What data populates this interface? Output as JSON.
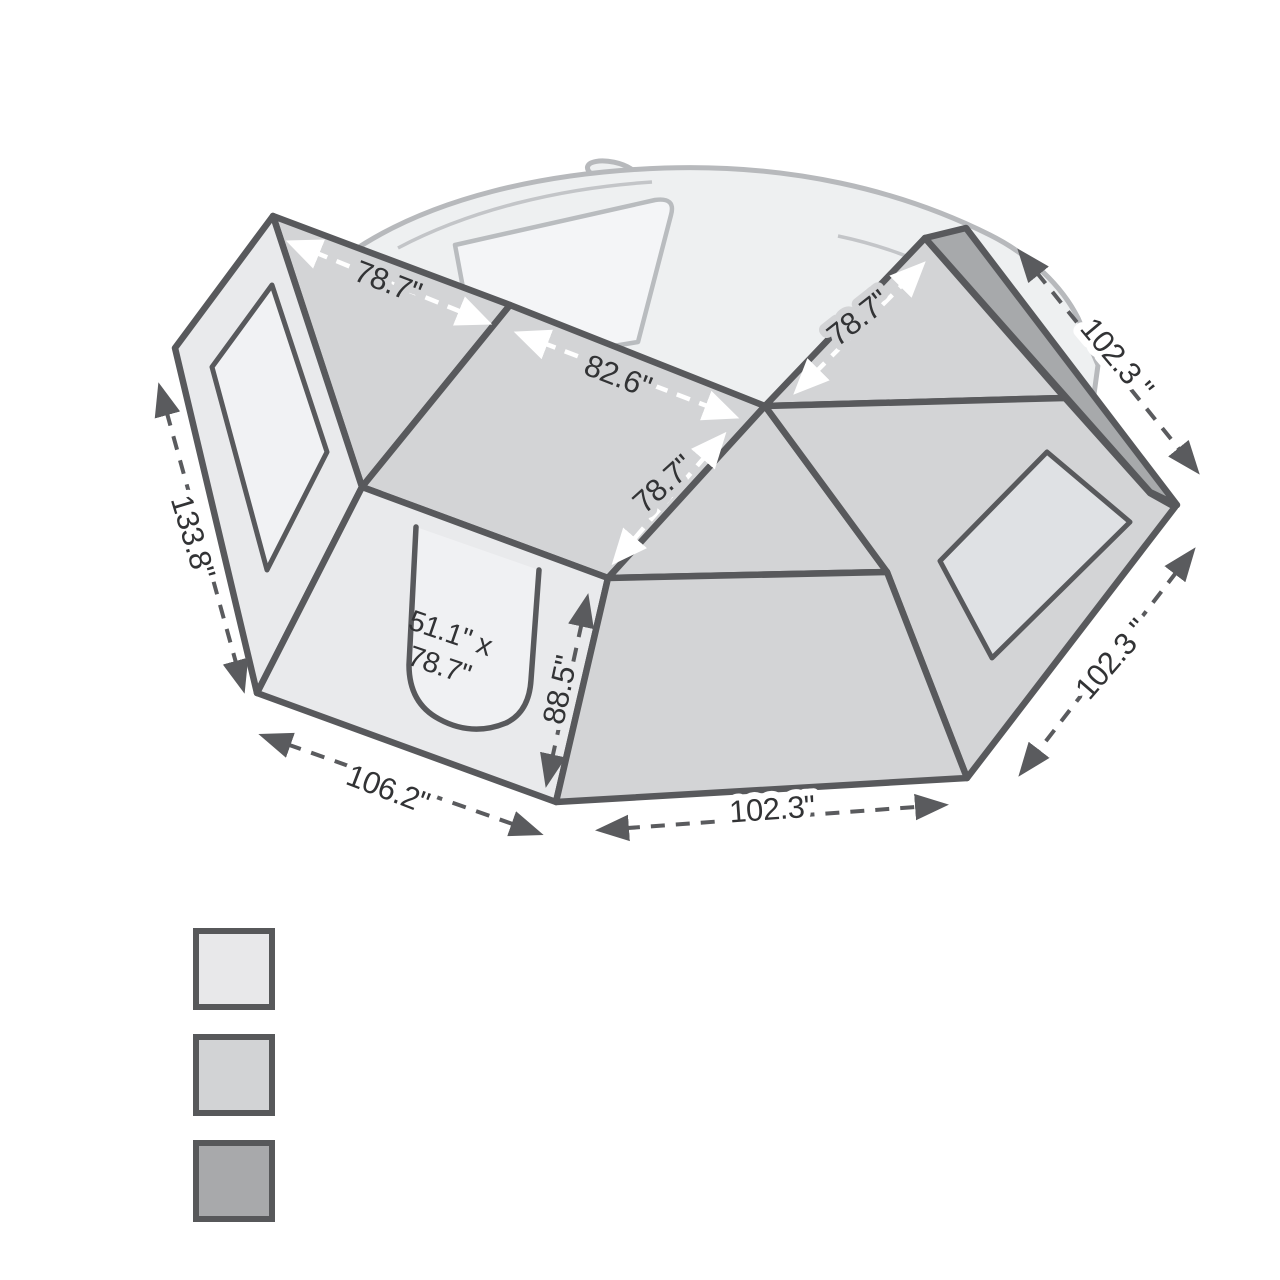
{
  "diagram": {
    "title": "270-degree awning with walls dimension diagram",
    "labels": {
      "roof_left_width": "78.7\"",
      "roof_mid_width": "82.6\"",
      "roof_diag_depth": "78.7\"",
      "roof_right_width": "78.7\"",
      "mount_edge_length": "102.3 \"",
      "right_wall_width": "102.3 \"",
      "left_wall_width": "133.8\"",
      "door_wall_width": "106.2\"",
      "front_wall_width": "102.3\"",
      "wall_height": "88.5\"",
      "door_size_line1": "51.1\" x",
      "door_size_line2": "78.7\""
    },
    "legend": {
      "swatches": [
        {
          "name": "light-fabric",
          "color": "#e8e8ea"
        },
        {
          "name": "mid-fabric",
          "color": "#d2d3d5"
        },
        {
          "name": "dark-mount-strip",
          "color": "#a8a9ab"
        }
      ]
    }
  }
}
